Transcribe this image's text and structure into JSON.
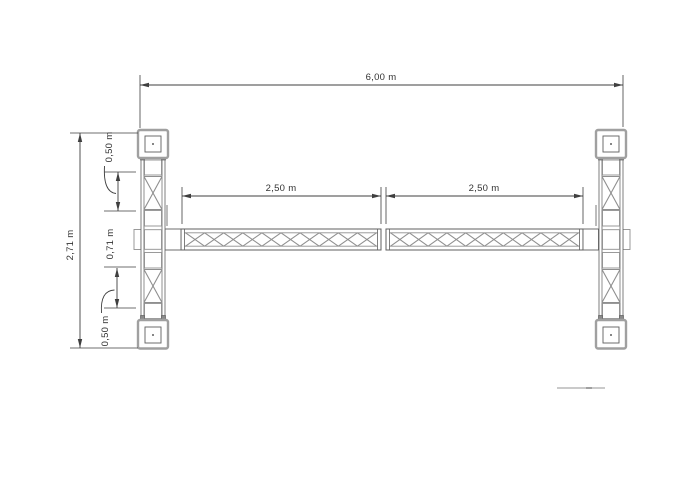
{
  "drawing": {
    "dimensions": {
      "total_width": "6,00 m",
      "left_span": "2,50 m",
      "right_span": "2,50 m",
      "total_height": "2,71 m",
      "upper_segment": "0,50 m",
      "middle_segment": "0,71 m",
      "lower_segment": "0,50 m"
    },
    "colors": {
      "background": "#ffffff",
      "dimension_line": "#3f3f3f",
      "structure_dark": "#5f5f5f",
      "structure_mid": "#8f8f8f",
      "structure_light": "#a0a0a0",
      "text": "#333333",
      "faint_line": "#b8b8b8"
    }
  }
}
